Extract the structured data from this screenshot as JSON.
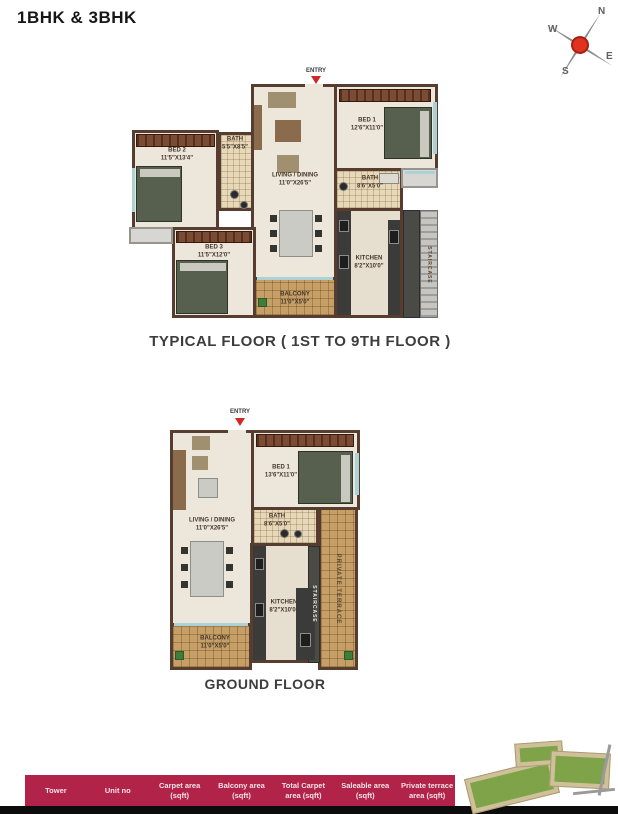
{
  "page": {
    "title": "1BHK & 3BHK"
  },
  "compass": {
    "n": "N",
    "e": "E",
    "s": "S",
    "w": "W"
  },
  "typical_floor": {
    "entry": "ENTRY",
    "caption": "TYPICAL FLOOR ( 1ST TO 9TH FLOOR )",
    "rooms": {
      "bed2": {
        "name": "BED 2",
        "dim": "11'5\"X13'4\""
      },
      "bath2": {
        "name": "BATH",
        "dim": "5'5\"X8'5\""
      },
      "living": {
        "name": "LIVING / DINING",
        "dim": "11'0\"X26'5\""
      },
      "bed1": {
        "name": "BED 1",
        "dim": "12'6\"X11'0\""
      },
      "bath1": {
        "name": "BATH",
        "dim": "8'6\"X5'0\""
      },
      "bed3": {
        "name": "BED 3",
        "dim": "11'5\"X12'0\""
      },
      "kitchen": {
        "name": "KITCHEN",
        "dim": "8'2\"X10'0\""
      },
      "balcony": {
        "name": "BALCONY",
        "dim": "11'0\"X5'0\""
      },
      "staircase": {
        "name": "STAIRCASE"
      }
    }
  },
  "ground_floor": {
    "entry": "ENTRY",
    "caption": "GROUND FLOOR",
    "rooms": {
      "living": {
        "name": "LIVING / DINING",
        "dim": "11'0\"X26'5\""
      },
      "bed1": {
        "name": "BED 1",
        "dim": "13'6\"X11'0\""
      },
      "bath": {
        "name": "BATH",
        "dim": "8'6\"X5'0\""
      },
      "kitchen": {
        "name": "KITCHEN",
        "dim": "8'2\"X10'0\""
      },
      "balcony": {
        "name": "BALCONY",
        "dim": "11'0\"X5'0\""
      },
      "terrace": {
        "name": "PRIVATE TERRACE"
      },
      "staircase": {
        "name": "STAIRCASE"
      }
    }
  },
  "table": {
    "columns": [
      "Tower",
      "Unit no",
      "Carpet area (sqft)",
      "Balcony area (sqft)",
      "Total Carpet area (sqft)",
      "Saleable area (sqft)",
      "Private terrace area (sqft)"
    ]
  },
  "palette": {
    "header_bg": "#b12349",
    "wall": "#573d30",
    "floor": "#ede7db",
    "balcony": "#c59f66",
    "entry_arrow": "#cf2b24",
    "compass_center": "#e03220"
  }
}
